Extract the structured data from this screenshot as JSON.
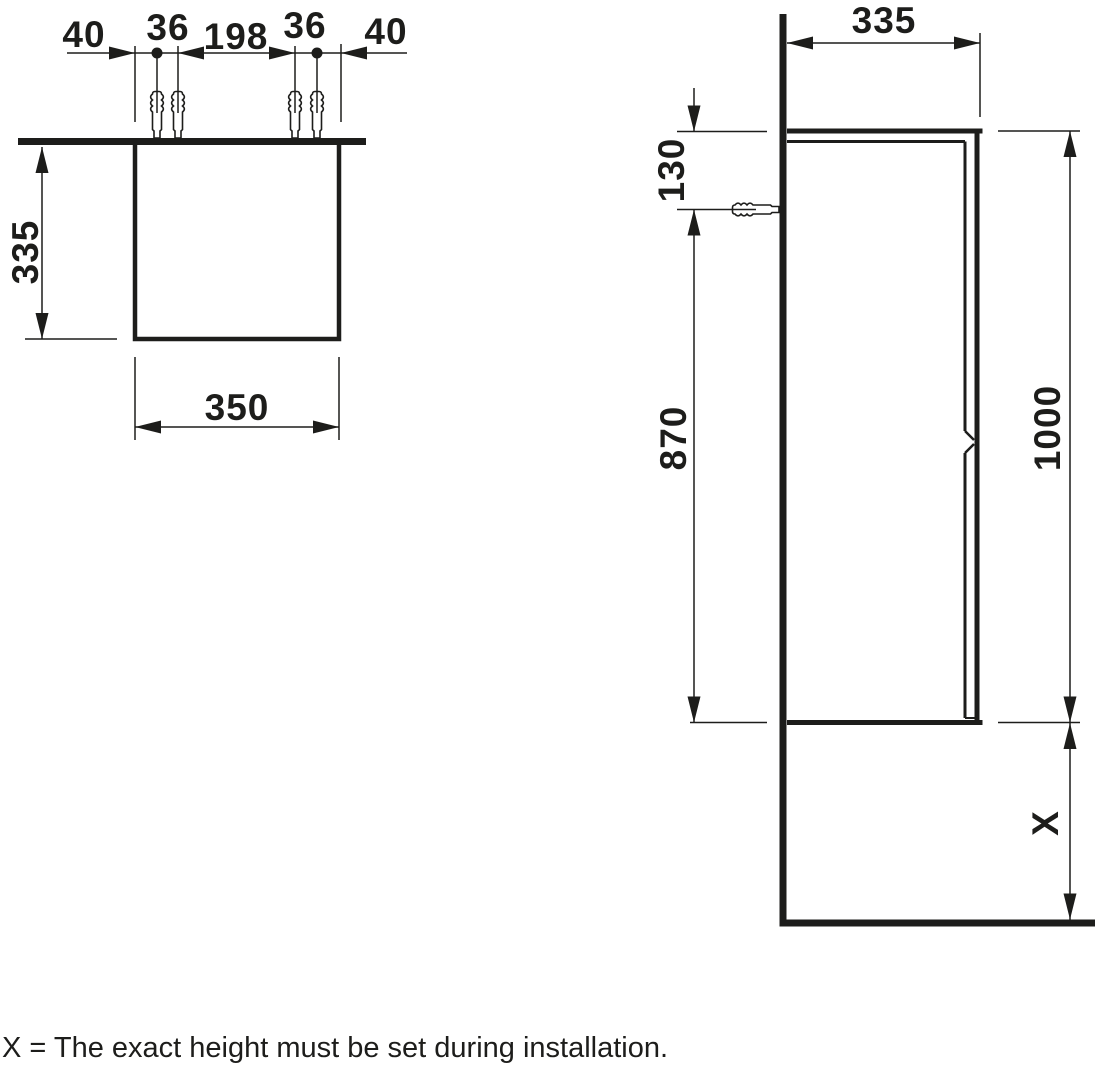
{
  "caption": "X = The exact height must be set during installation.",
  "top_view": {
    "chain_labels": [
      "40",
      "36",
      "198",
      "36",
      "40"
    ],
    "depth_label": "335",
    "width_label": "350"
  },
  "side_view": {
    "depth_label": "335",
    "top_fixing_label": "130",
    "fixing_to_bottom_label": "870",
    "height_label": "1000",
    "floor_clearance_label": "X"
  },
  "colors": {
    "ink": "#1d1d1b",
    "background": "#ffffff"
  }
}
